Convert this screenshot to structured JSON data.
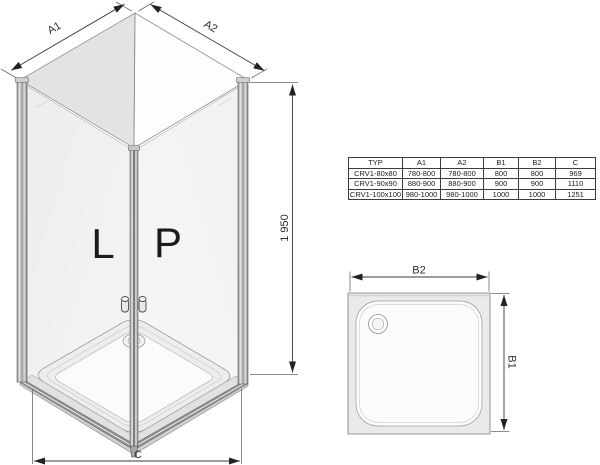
{
  "iso_view": {
    "door_left": "L",
    "door_right": "P",
    "dim_a1": "A1",
    "dim_a2": "A2",
    "dim_height": "1 950",
    "dim_width_bottom": "C"
  },
  "size_table": {
    "headers": [
      "TYP",
      "A1",
      "A2",
      "B1",
      "B2",
      "C"
    ],
    "rows": [
      [
        "CRV1-80x80",
        "780-800",
        "780-800",
        "800",
        "800",
        "969"
      ],
      [
        "CRV1-90x90",
        "880-900",
        "880-900",
        "900",
        "900",
        "1110"
      ],
      [
        "CRV1-100x100",
        "980-1000",
        "980-1000",
        "1000",
        "1000",
        "1251"
      ]
    ]
  },
  "tray_view": {
    "dim_b2": "B2",
    "dim_b1": "B1"
  },
  "colors": {
    "background": "#ffffff",
    "line": "#3a3a3a",
    "glass": "#f1f2f2",
    "shaded_top_panel": "#e2e3e3",
    "tray_fill": "#e9eaea"
  }
}
